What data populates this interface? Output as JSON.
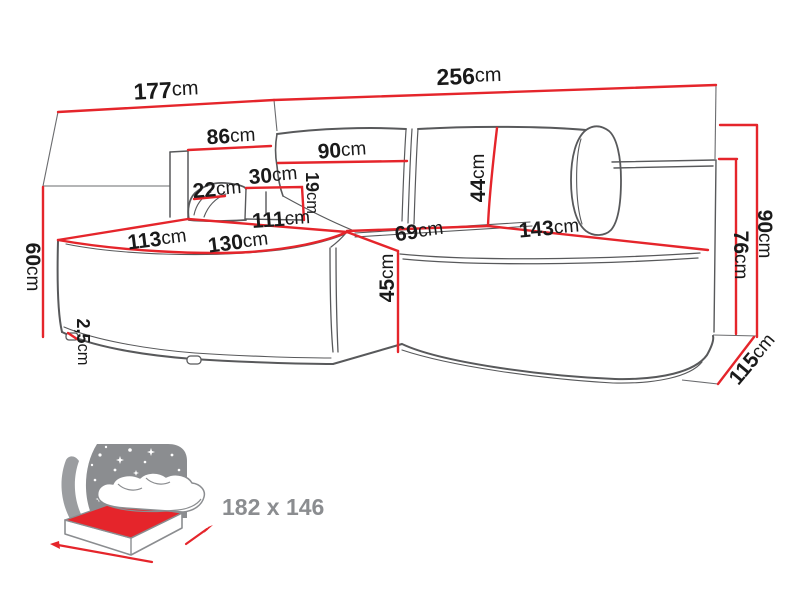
{
  "colors": {
    "dimension_red": "#e5252b",
    "outline_gray": "#58595b",
    "icon_gray": "#8b8d90",
    "label_black": "#1a1a1a",
    "background": "#ffffff"
  },
  "sofa_diagram": {
    "type": "corner-sofa-dimension-drawing",
    "dims": {
      "d177": {
        "num": "177",
        "unit": "cm"
      },
      "d256": {
        "num": "256",
        "unit": "cm"
      },
      "d86": {
        "num": "86",
        "unit": "cm"
      },
      "d90top": {
        "num": "90",
        "unit": "cm"
      },
      "d30": {
        "num": "30",
        "unit": "cm"
      },
      "d19": {
        "num": "19",
        "unit": "cm"
      },
      "d22": {
        "num": "22",
        "unit": "cm"
      },
      "d60": {
        "num": "60",
        "unit": "cm"
      },
      "d111": {
        "num": "111",
        "unit": "cm"
      },
      "d113": {
        "num": "113",
        "unit": "cm"
      },
      "d130": {
        "num": "130",
        "unit": "cm"
      },
      "d69": {
        "num": "69",
        "unit": "cm"
      },
      "d44": {
        "num": "44",
        "unit": "cm"
      },
      "d45": {
        "num": "45",
        "unit": "cm"
      },
      "d143": {
        "num": "143",
        "unit": "cm"
      },
      "d25": {
        "num": "2,5",
        "unit": "cm"
      },
      "d90right": {
        "num": "90",
        "unit": "cm"
      },
      "d76": {
        "num": "76",
        "unit": "cm"
      },
      "d115": {
        "num": "115",
        "unit": "cm"
      }
    },
    "sleeping_area": {
      "label": "182 x 146"
    }
  }
}
